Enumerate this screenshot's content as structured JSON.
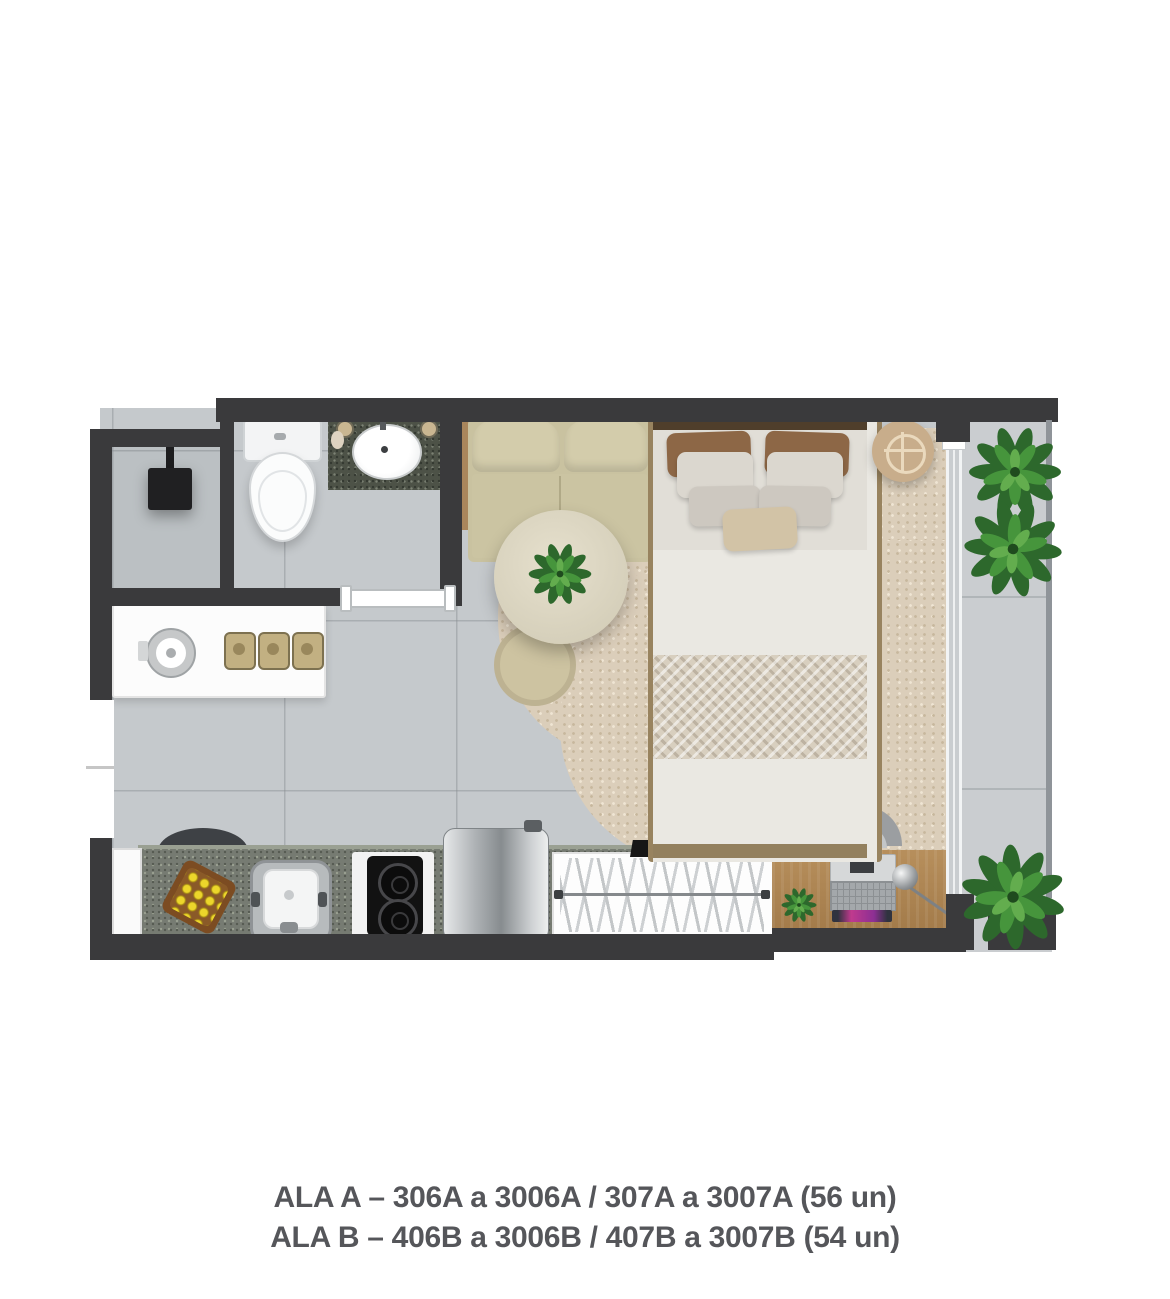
{
  "caption": {
    "line1": "ALA A – 306A a 3006A / 307A a 3007A (56 un)",
    "line2": "ALA B – 406B a 3006B / 407B a 3007B (54 un)"
  },
  "floorplan": {
    "type": "studio-apartment-floor-plan-top-view",
    "rooms": [
      "bathroom",
      "kitchen",
      "living-bedroom",
      "balcony"
    ],
    "colors": {
      "wall": "#3a3a3c",
      "floor": "#c5c9cc",
      "balcony_floor": "#cacdd0",
      "rug": "#dbceba",
      "wood": "#a9865c",
      "kitchen_granite": "#767b72",
      "vanity_granite": "#4d5247",
      "sofa": "#c9c2a0",
      "bed_duvet": "#eae8e2",
      "pillow_brown": "#8d6746",
      "plant_green": "#3c7d38",
      "caption_text": "#55565a"
    },
    "furniture": [
      "shower-head",
      "toilet",
      "bathroom-vanity-sink",
      "sliding-bathroom-door",
      "entry-door-opening",
      "kitchen-shelf",
      "kettle",
      "canisters",
      "kitchen-counter",
      "stool",
      "fruit-tray",
      "kitchen-sink",
      "cooktop",
      "refrigerator",
      "clothes-rack",
      "tv",
      "desk",
      "laptop",
      "desk-lamp",
      "desk-plant",
      "desk-chair",
      "sofa",
      "side-shelf",
      "round-table",
      "table-plant",
      "dining-chair",
      "rug",
      "double-bed",
      "bedside-tray-table",
      "balcony-sliding-door-track",
      "balcony-plant-top",
      "balcony-plant-bottom"
    ]
  }
}
